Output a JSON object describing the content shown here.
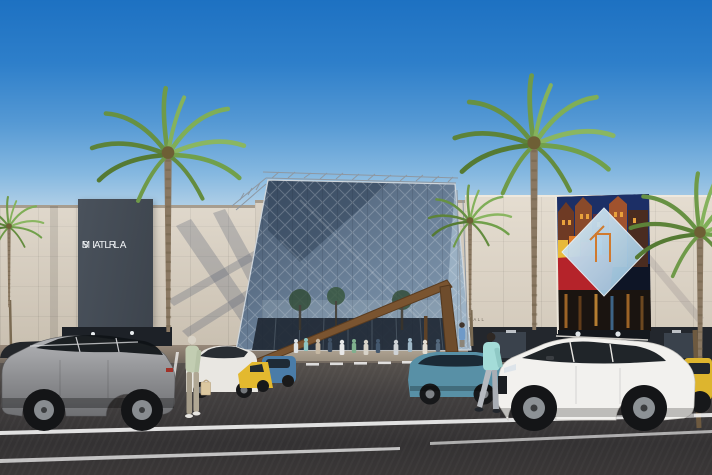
{
  "scene": {
    "title": "Sitra Mall exterior rendering",
    "sign": {
      "line1": "SITRA",
      "line2": "MALL"
    },
    "wall_text": "SITRA MALL"
  },
  "colors": {
    "sky_top": "#1d71c2",
    "sky_horizon": "#b7d3e8",
    "facade": "#d6ccbc",
    "facade_sunlit": "#ddd3c3",
    "sign_panel": "#454c55",
    "sign_text": "#eef1f4",
    "glass_blue": "#5d7289",
    "glass_light": "#a7bccd",
    "timber_beam": "#7a5430",
    "asphalt": "#3c3a3a",
    "billboard_navy": "#1c2f66",
    "billboard_ship_red": "#b5232a",
    "billboard_diamond": "#bcdcef",
    "palm_green": "#6f9a49",
    "palm_trunk": "#8a7862"
  }
}
